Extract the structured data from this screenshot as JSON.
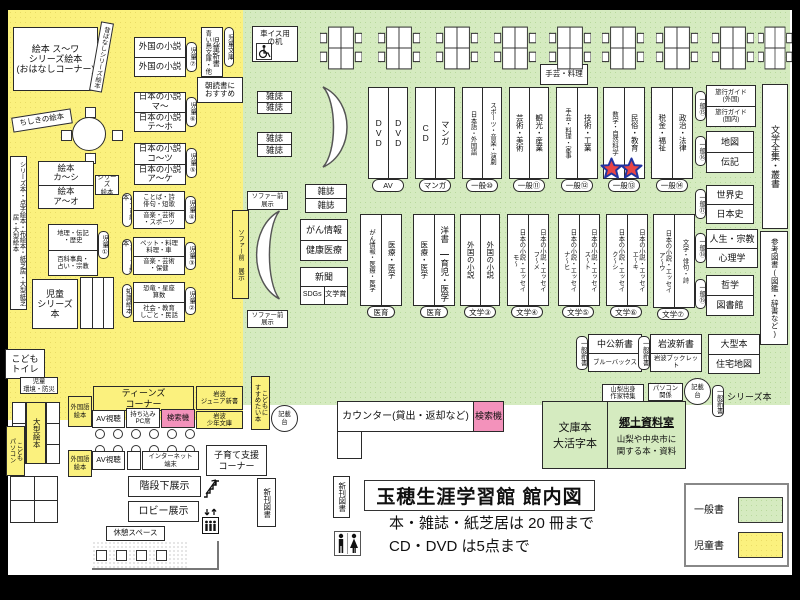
{
  "title_block": {
    "heading": "玉穂生涯学習館 館内図",
    "rule1": "本・雑誌・紙芝居は 20 冊まで",
    "rule2": "CD・DVD は5点まで"
  },
  "legend": {
    "general": "一般書",
    "children": "児童書",
    "general_color": "#d5ebc0",
    "children_color": "#fbf17e"
  },
  "children_zone": {
    "ohanashi": "絵本 ス〜ワ\nシリーズ絵本\n(おはなしコーナー)",
    "mukashi": "昔ばなしシリーズ絵本",
    "chishiki": "ちしきの絵本",
    "jidou_shinsho": "児童新書",
    "aoitori": "青い鳥文庫・他",
    "jidou_bunko": "児童文庫",
    "asadoku": "朝読書に\nおすすめ",
    "shelf7": [
      "外国の小説",
      "外国の小説"
    ],
    "tag7": "児童⑦",
    "shelf6": [
      "日本の小説\nマ〜",
      "日本の小説\nテ〜ホ"
    ],
    "tag6": "児童⑥",
    "shelf5": [
      "日本の小説\nコ〜ツ",
      "日本の小説\nア〜ケ"
    ],
    "tag5": "児童⑤",
    "left_strip": "シリーズ本・点字絵本・布絵本・紙芝居・大型紙芝居・大型絵本",
    "ehon": [
      "絵本\nカ〜シ",
      "絵本\nア〜オ"
    ],
    "series_tag": "シリーズ\n絵本",
    "chiri": [
      "地理・伝記\n・歴史",
      "百科事典・\n占い・宗教"
    ],
    "tag1": "児童①",
    "kotoba": [
      "ことば・詩\n俳句・短歌",
      "音楽・芸術\n・スポーツ"
    ],
    "tag4": "児童④",
    "asobi": "あそび絵本",
    "pet": [
      "ペット・料理\n料理・車",
      "音楽・芸術\n・保健"
    ],
    "tag3": "児童③",
    "series2": "シリーズ絵本",
    "kyoryu": [
      "恐竜・星座\n算数",
      "社会・教育\nしごと・民話"
    ],
    "tag2": "児童②",
    "chishiki_ehon": "知識絵本",
    "jidou_series": "児童\nシリーズ本",
    "toilet": "こども\nトイレ",
    "bosai": "児童\n環境・防災",
    "ogata_ehon": "大型絵本",
    "kodomo_pc": "こども\nパソコン",
    "teens": "ティーンズ\nコーナー",
    "av": "AV視聴",
    "pc_seat": "持ち込み\nPC席",
    "kensakuki": "検索機",
    "gaikokugo": "外国語\n絵本",
    "iwanami_jr": "岩波\nジュニア新書",
    "iwanami_shonen": "岩波\n少年文庫",
    "internet": "インターネット\n端末",
    "kosodate": "子育て支援\nコーナー",
    "kaidan": "階段下展示",
    "lobby": "ロビー展示",
    "kyukei": "休憩スペース",
    "shinkan": "新刊図書"
  },
  "general_zone": {
    "wheelchair_desk": "車イス用\nの机",
    "zasshi": "雑誌",
    "sofa_strip": "ソファー前 展示",
    "sofa_small": "ソファー前\n展示",
    "gan": [
      "がん情報",
      "健康医療"
    ],
    "shinbun": "新聞",
    "sdgs": "SDGs",
    "bungakusho": "文学賞",
    "p_dvd": [
      "DVD",
      "DVD"
    ],
    "t_av": "AV",
    "p_cd": [
      "CD",
      "マンガ"
    ],
    "t_manga": "マンガ",
    "p_lang": [
      "日本語・外国語",
      "スポーツ・音楽・演劇"
    ],
    "t10": "一般⑩",
    "p_art": [
      "芸術・美術",
      "観光・産業"
    ],
    "t11": "一般⑪",
    "p_craft": [
      "手芸・料理・家事",
      "技術・工業"
    ],
    "t12": "一般⑫",
    "craft_top": "手芸・料理",
    "p_math": [
      "数学・自然科学",
      "民俗・教育"
    ],
    "t13": "一般⑬",
    "p_tax": [
      "税金・福祉",
      "政治・法律"
    ],
    "t14": "一般⑭",
    "travel": [
      "旅行ガイド\n(外国)",
      "旅行ガイド\n(国内)"
    ],
    "t15": "一般⑮",
    "chizu": [
      "地図",
      "伝記"
    ],
    "t16": "一般⑯",
    "zenshu": "文学全集・叢書",
    "rekishi": [
      "世界史",
      "日本史"
    ],
    "t17": "一般⑰",
    "jinsei": [
      "人生・宗教",
      "心理学"
    ],
    "t18": "一般⑱",
    "tetsugaku": [
      "哲学",
      "図書館"
    ],
    "t19": "一般⑲",
    "sanko": "参考図書(図鑑・辞書など)",
    "p_gan": [
      "がん情報・医療・医学",
      "医療・医学"
    ],
    "t_iiku": "医育",
    "p_med_left": "医療・医学",
    "yosho": "洋書",
    "ikuji": "育児・医学",
    "p_foreign": [
      "外国の小説",
      "外国の小説"
    ],
    "b3": "文学③",
    "p_jp1": [
      "日本の小説・エッセイ\nモ〜",
      "日本の小説・エッセイ\nフ〜メ"
    ],
    "b4": "文学④",
    "p_jp2": [
      "日本の小説・エッセイ\nナ〜ヒ",
      "日本の小説・エッセイ\nス〜ト"
    ],
    "b5": "文学⑤",
    "p_jp3": [
      "日本の小説・エッセイ\nク〜シ",
      "日本の小説・エッセイ\nエ〜キ"
    ],
    "b6": "文学⑥",
    "p_jp4": [
      "日本の小説・エッセイ\nア〜ウ",
      "文学・俳句・詩"
    ],
    "b7": "文学⑦",
    "chuko": [
      "中公新書",
      "ブルーバックス"
    ],
    "t_shinsho": "一般新書",
    "iwanami": [
      "岩波新書",
      "岩波ブックレット"
    ],
    "ogata": [
      "大型本",
      "住宅地図"
    ],
    "yamanashi": "山梨出身\n作家特集",
    "pc_kankei": "パソコン\n関係",
    "kisaidai": "記載\n台",
    "series_bon": "シリーズ本",
    "counter": "カウンター(貸出・返却など)",
    "kensakuki": "検索機",
    "kodomo_susume": "こどもに\nすすめたい本",
    "bunko": "文庫本\n大活字本",
    "kyodo_title": "郷土資料室",
    "kyodo_desc": "山梨や中央市に\n関する本・資料"
  }
}
